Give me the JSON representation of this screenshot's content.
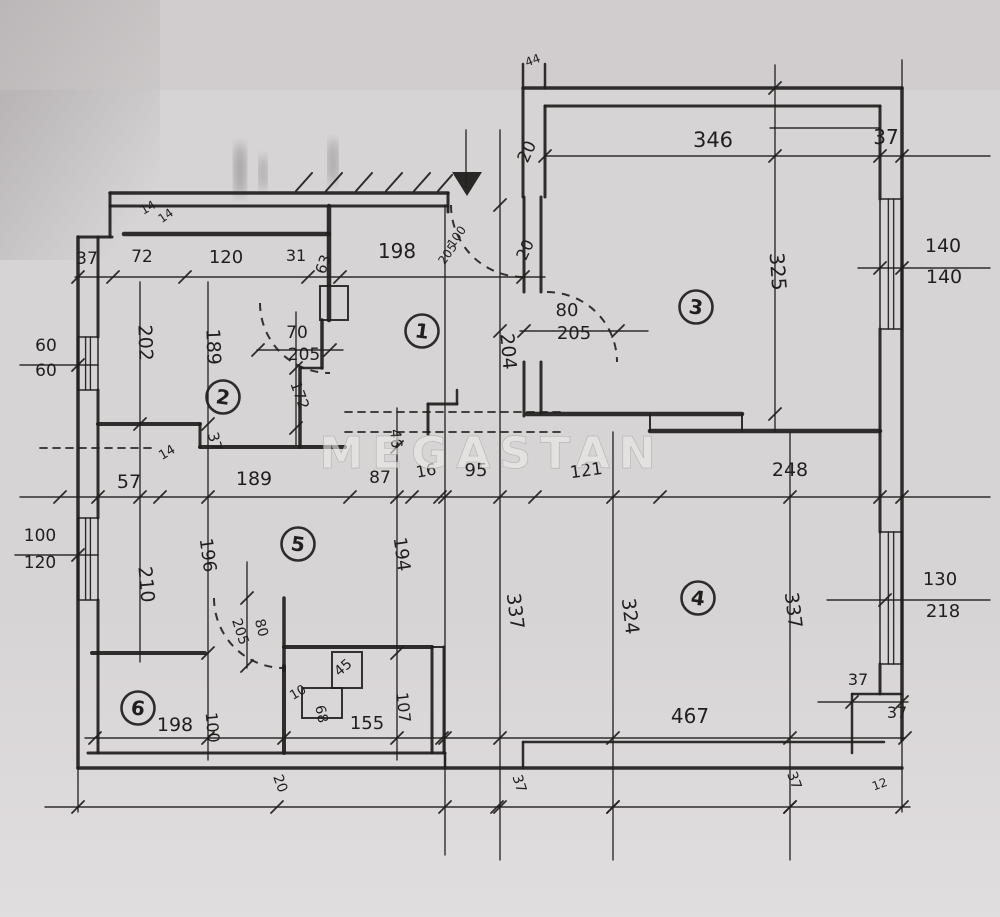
{
  "meta": {
    "type": "hand-drawn floor plan sketch",
    "units_hint": "cm"
  },
  "watermark": {
    "text": "MEGASTAN"
  },
  "paper": {
    "bg": "#d7d4d5",
    "bg_light": "#dedbdc",
    "shadow": "#8e898b",
    "ink": "#211f1e"
  },
  "rooms": [
    {
      "n": "1",
      "x": 422,
      "y": 331
    },
    {
      "n": "2",
      "x": 223,
      "y": 397
    },
    {
      "n": "3",
      "x": 696,
      "y": 307
    },
    {
      "n": "4",
      "x": 698,
      "y": 598
    },
    {
      "n": "5",
      "x": 298,
      "y": 544
    },
    {
      "n": "6",
      "x": 138,
      "y": 708
    }
  ],
  "labels": [
    {
      "t": "346",
      "x": 713,
      "y": 147,
      "r": 0,
      "s": 21
    },
    {
      "t": "37",
      "x": 886,
      "y": 144,
      "r": 0,
      "s": 20
    },
    {
      "t": "20",
      "x": 532,
      "y": 154,
      "r": -65,
      "s": 17
    },
    {
      "t": "44",
      "x": 534,
      "y": 64,
      "r": -20,
      "s": 12
    },
    {
      "t": "140",
      "x": 943,
      "y": 252,
      "r": 0,
      "s": 19
    },
    {
      "t": "140",
      "x": 944,
      "y": 283,
      "r": 0,
      "s": 19
    },
    {
      "t": "325",
      "x": 771,
      "y": 272,
      "r": 86,
      "s": 20
    },
    {
      "t": "80",
      "x": 567,
      "y": 316,
      "r": 0,
      "s": 18
    },
    {
      "t": "205",
      "x": 574,
      "y": 339,
      "r": 0,
      "s": 18
    },
    {
      "t": "20",
      "x": 530,
      "y": 252,
      "r": -65,
      "s": 16
    },
    {
      "t": "204",
      "x": 502,
      "y": 352,
      "r": 85,
      "s": 19
    },
    {
      "t": "198",
      "x": 397,
      "y": 258,
      "r": 0,
      "s": 20
    },
    {
      "t": "100",
      "x": 460,
      "y": 239,
      "r": -55,
      "s": 12
    },
    {
      "t": "205",
      "x": 451,
      "y": 256,
      "r": -55,
      "s": 12
    },
    {
      "t": "37",
      "x": 87,
      "y": 264,
      "r": 0,
      "s": 17
    },
    {
      "t": "72",
      "x": 142,
      "y": 262,
      "r": 0,
      "s": 17
    },
    {
      "t": "120",
      "x": 226,
      "y": 263,
      "r": 0,
      "s": 18
    },
    {
      "t": "31",
      "x": 296,
      "y": 261,
      "r": 0,
      "s": 16
    },
    {
      "t": "63",
      "x": 328,
      "y": 266,
      "r": -70,
      "s": 15
    },
    {
      "t": "14",
      "x": 150,
      "y": 211,
      "r": -30,
      "s": 12
    },
    {
      "t": "14",
      "x": 168,
      "y": 219,
      "r": -35,
      "s": 12
    },
    {
      "t": "202",
      "x": 139,
      "y": 343,
      "r": 88,
      "s": 19
    },
    {
      "t": "189",
      "x": 207,
      "y": 347,
      "r": 88,
      "s": 19
    },
    {
      "t": "70",
      "x": 297,
      "y": 338,
      "r": 0,
      "s": 17
    },
    {
      "t": "205",
      "x": 304,
      "y": 360,
      "r": 0,
      "s": 17
    },
    {
      "t": "172",
      "x": 295,
      "y": 397,
      "r": 70,
      "s": 15
    },
    {
      "t": "60",
      "x": 46,
      "y": 351,
      "r": 0,
      "s": 17
    },
    {
      "t": "60",
      "x": 46,
      "y": 376,
      "r": 0,
      "s": 17
    },
    {
      "t": "37",
      "x": 210,
      "y": 443,
      "r": 75,
      "s": 15
    },
    {
      "t": "14",
      "x": 169,
      "y": 456,
      "r": -30,
      "s": 13
    },
    {
      "t": "57",
      "x": 129,
      "y": 488,
      "r": 0,
      "s": 19
    },
    {
      "t": "189",
      "x": 254,
      "y": 485,
      "r": 0,
      "s": 19
    },
    {
      "t": "87",
      "x": 380,
      "y": 483,
      "r": 0,
      "s": 17
    },
    {
      "t": "16",
      "x": 427,
      "y": 476,
      "r": -10,
      "s": 16
    },
    {
      "t": "95",
      "x": 476,
      "y": 476,
      "r": 0,
      "s": 18
    },
    {
      "t": "46",
      "x": 391,
      "y": 439,
      "r": 85,
      "s": 15
    },
    {
      "t": "121",
      "x": 587,
      "y": 476,
      "r": -8,
      "s": 17
    },
    {
      "t": "248",
      "x": 790,
      "y": 476,
      "r": 0,
      "s": 19
    },
    {
      "t": "100",
      "x": 40,
      "y": 541,
      "r": 0,
      "s": 17
    },
    {
      "t": "120",
      "x": 40,
      "y": 568,
      "r": 0,
      "s": 17
    },
    {
      "t": "210",
      "x": 140,
      "y": 585,
      "r": 85,
      "s": 19
    },
    {
      "t": "196",
      "x": 202,
      "y": 556,
      "r": 82,
      "s": 18
    },
    {
      "t": "194",
      "x": 396,
      "y": 555,
      "r": 82,
      "s": 18
    },
    {
      "t": "337",
      "x": 509,
      "y": 612,
      "r": 83,
      "s": 19
    },
    {
      "t": "324",
      "x": 624,
      "y": 617,
      "r": 83,
      "s": 19
    },
    {
      "t": "337",
      "x": 787,
      "y": 611,
      "r": 83,
      "s": 19
    },
    {
      "t": "130",
      "x": 940,
      "y": 585,
      "r": 0,
      "s": 18
    },
    {
      "t": "218",
      "x": 943,
      "y": 617,
      "r": 0,
      "s": 18
    },
    {
      "t": "205",
      "x": 236,
      "y": 633,
      "r": 72,
      "s": 14
    },
    {
      "t": "80",
      "x": 257,
      "y": 629,
      "r": 75,
      "s": 14
    },
    {
      "t": "198",
      "x": 175,
      "y": 731,
      "r": 0,
      "s": 19
    },
    {
      "t": "100",
      "x": 207,
      "y": 728,
      "r": 85,
      "s": 16
    },
    {
      "t": "45",
      "x": 346,
      "y": 671,
      "r": -40,
      "s": 14
    },
    {
      "t": "10",
      "x": 300,
      "y": 696,
      "r": -30,
      "s": 13
    },
    {
      "t": "68",
      "x": 317,
      "y": 715,
      "r": 78,
      "s": 14
    },
    {
      "t": "107",
      "x": 398,
      "y": 708,
      "r": 84,
      "s": 16
    },
    {
      "t": "155",
      "x": 367,
      "y": 729,
      "r": 0,
      "s": 18
    },
    {
      "t": "20",
      "x": 276,
      "y": 785,
      "r": 70,
      "s": 14
    },
    {
      "t": "467",
      "x": 690,
      "y": 723,
      "r": 0,
      "s": 20
    },
    {
      "t": "37",
      "x": 515,
      "y": 785,
      "r": 72,
      "s": 14
    },
    {
      "t": "37",
      "x": 858,
      "y": 685,
      "r": 0,
      "s": 16
    },
    {
      "t": "37",
      "x": 897,
      "y": 718,
      "r": 0,
      "s": 16
    },
    {
      "t": "37",
      "x": 790,
      "y": 782,
      "r": 70,
      "s": 14
    },
    {
      "t": "12",
      "x": 881,
      "y": 788,
      "r": -20,
      "s": 12
    }
  ],
  "walls": [
    [
      110,
      193,
      448,
      193,
      3.5
    ],
    [
      110,
      206,
      448,
      206,
      3
    ],
    [
      110,
      193,
      110,
      237,
      3
    ],
    [
      78,
      237,
      112,
      237,
      3
    ],
    [
      78,
      237,
      78,
      768,
      3.5
    ],
    [
      98,
      237,
      98,
      337,
      3
    ],
    [
      98,
      390,
      98,
      518,
      3
    ],
    [
      98,
      600,
      98,
      753,
      3
    ],
    [
      88,
      753,
      445,
      753,
      3
    ],
    [
      523,
      742,
      884,
      742,
      2.5
    ],
    [
      445,
      753,
      445,
      768,
      2.5
    ],
    [
      523,
      742,
      523,
      768,
      2.5
    ],
    [
      78,
      768,
      902,
      768,
      3.5
    ],
    [
      902,
      88,
      902,
      740,
      3.5
    ],
    [
      852,
      694,
      902,
      694,
      2.5
    ],
    [
      852,
      694,
      852,
      753,
      2.5
    ],
    [
      880,
      106,
      880,
      199,
      3
    ],
    [
      880,
      329,
      880,
      532,
      3
    ],
    [
      880,
      664,
      880,
      694,
      3
    ],
    [
      523,
      88,
      902,
      88,
      3.5
    ],
    [
      545,
      106,
      880,
      106,
      3
    ],
    [
      523,
      88,
      523,
      197,
      3
    ],
    [
      545,
      106,
      545,
      197,
      3
    ],
    [
      448,
      193,
      448,
      212,
      3
    ],
    [
      523,
      64,
      523,
      88,
      2.5
    ],
    [
      545,
      64,
      545,
      88,
      2.5
    ],
    [
      124,
      234,
      329,
      234,
      4.5
    ],
    [
      329,
      206,
      329,
      320,
      4.5
    ],
    [
      524,
      197,
      524,
      292,
      3
    ],
    [
      541,
      197,
      541,
      292,
      3
    ],
    [
      524,
      362,
      524,
      416,
      3
    ],
    [
      541,
      362,
      541,
      414,
      3
    ],
    [
      527,
      414,
      742,
      414,
      4.5
    ],
    [
      650,
      431,
      880,
      431,
      4.5
    ],
    [
      650,
      414,
      650,
      431,
      2
    ],
    [
      742,
      414,
      742,
      431,
      2
    ],
    [
      98,
      424,
      200,
      424,
      4
    ],
    [
      200,
      424,
      200,
      447,
      3
    ],
    [
      200,
      447,
      345,
      447,
      4
    ],
    [
      300,
      368,
      300,
      447,
      3.5
    ],
    [
      322,
      320,
      322,
      368,
      3.5
    ],
    [
      300,
      368,
      322,
      368,
      2.5
    ],
    [
      428,
      404,
      428,
      434,
      3
    ],
    [
      428,
      404,
      457,
      404,
      3
    ],
    [
      457,
      390,
      457,
      404,
      2.5
    ],
    [
      92,
      653,
      205,
      653,
      4
    ],
    [
      284,
      598,
      284,
      670,
      3.5
    ],
    [
      284,
      666,
      284,
      753,
      4
    ],
    [
      284,
      647,
      432,
      647,
      4
    ],
    [
      432,
      647,
      432,
      753,
      3
    ],
    [
      444,
      647,
      444,
      753,
      3
    ],
    [
      432,
      647,
      444,
      647,
      2
    ]
  ],
  "windows": [
    [
      78,
      337,
      20,
      53
    ],
    [
      78,
      518,
      20,
      82
    ],
    [
      880,
      199,
      22,
      130
    ],
    [
      880,
      532,
      22,
      132
    ]
  ],
  "rects": [
    [
      320,
      286,
      28,
      34
    ],
    [
      302,
      688,
      40,
      30
    ],
    [
      332,
      652,
      30,
      36
    ]
  ],
  "dimlines": [
    {
      "x1": 545,
      "y1": 156,
      "x2": 990,
      "y2": 156,
      "ticks": [
        545,
        880,
        902
      ]
    },
    {
      "x1": 858,
      "y1": 268,
      "x2": 990,
      "y2": 268,
      "ticks": [
        880,
        902
      ]
    },
    {
      "x1": 520,
      "y1": 331,
      "x2": 648,
      "y2": 331,
      "ticks": [
        524,
        618
      ]
    },
    {
      "x1": 75,
      "y1": 277,
      "x2": 545,
      "y2": 277,
      "ticks": [
        78,
        113,
        185,
        308,
        340,
        523
      ]
    },
    {
      "x1": 20,
      "y1": 365,
      "x2": 98,
      "y2": 365,
      "ticks": [
        78
      ]
    },
    {
      "x1": 20,
      "y1": 497,
      "x2": 990,
      "y2": 497,
      "ticks": [
        60,
        98,
        160,
        350,
        412,
        440,
        535,
        660,
        880,
        902
      ]
    },
    {
      "x1": 15,
      "y1": 555,
      "x2": 98,
      "y2": 555,
      "ticks": [
        78
      ]
    },
    {
      "x1": 827,
      "y1": 600,
      "x2": 990,
      "y2": 600,
      "ticks": [
        885
      ]
    },
    {
      "x1": 85,
      "y1": 738,
      "x2": 905,
      "y2": 738,
      "ticks": [
        95,
        284,
        442,
        905
      ]
    },
    {
      "x1": 45,
      "y1": 807,
      "x2": 910,
      "y2": 807,
      "ticks": [
        78,
        277,
        497,
        613,
        790,
        902
      ]
    },
    {
      "x1": 257,
      "y1": 350,
      "x2": 343,
      "y2": 350,
      "ticks": [
        258,
        330
      ]
    },
    {
      "x1": 770,
      "y1": 128,
      "x2": 880,
      "y2": 128,
      "ticks": []
    },
    {
      "x1": 818,
      "y1": 702,
      "x2": 908,
      "y2": 702,
      "ticks": [
        852,
        902
      ]
    },
    {
      "x1": 140,
      "y1": 282,
      "x2": 140,
      "y2": 662,
      "ticks": [
        424,
        497
      ]
    },
    {
      "x1": 208,
      "y1": 282,
      "x2": 208,
      "y2": 760,
      "ticks": [
        424,
        497,
        653,
        738
      ]
    },
    {
      "x1": 296,
      "y1": 312,
      "x2": 296,
      "y2": 445,
      "ticks": [
        368,
        428
      ]
    },
    {
      "x1": 397,
      "y1": 408,
      "x2": 397,
      "y2": 760,
      "ticks": [
        447,
        497,
        653,
        738
      ]
    },
    {
      "x1": 445,
      "y1": 205,
      "x2": 445,
      "y2": 855,
      "ticks": [
        497,
        738,
        807
      ]
    },
    {
      "x1": 500,
      "y1": 130,
      "x2": 500,
      "y2": 860,
      "ticks": [
        205,
        331,
        497,
        738,
        807
      ]
    },
    {
      "x1": 613,
      "y1": 432,
      "x2": 613,
      "y2": 860,
      "ticks": [
        497,
        738,
        807
      ]
    },
    {
      "x1": 775,
      "y1": 65,
      "x2": 775,
      "y2": 432,
      "ticks": [
        88,
        156,
        414
      ]
    },
    {
      "x1": 790,
      "y1": 432,
      "x2": 790,
      "y2": 860,
      "ticks": [
        497,
        738,
        807
      ]
    },
    {
      "x1": 78,
      "y1": 768,
      "x2": 78,
      "y2": 812,
      "ticks": []
    },
    {
      "x1": 902,
      "y1": 740,
      "x2": 902,
      "y2": 812,
      "ticks": []
    },
    {
      "x1": 902,
      "y1": 60,
      "x2": 902,
      "y2": 88,
      "ticks": []
    },
    {
      "x1": 247,
      "y1": 562,
      "x2": 247,
      "y2": 668,
      "ticks": [
        598,
        666
      ]
    },
    {
      "x1": 466,
      "y1": 130,
      "x2": 466,
      "y2": 188,
      "ticks": []
    }
  ],
  "dashes": [
    [
      345,
      412,
      560,
      412
    ],
    [
      345,
      432,
      560,
      432
    ],
    [
      40,
      448,
      155,
      448
    ]
  ],
  "arcs": [
    "M451,205 A72,72 0 0 0 523,277",
    "M547,292 A70,70 0 0 1 617,362",
    "M260,303 A70,70 0 0 0 330,373",
    "M214,598 A70,70 0 0 0 284,668"
  ],
  "hatch": [
    [
      296,
      191,
      312,
      173
    ],
    [
      326,
      191,
      342,
      173
    ],
    [
      356,
      191,
      372,
      173
    ],
    [
      386,
      191,
      402,
      173
    ],
    [
      414,
      191,
      430,
      173
    ],
    [
      438,
      191,
      452,
      175
    ]
  ],
  "triangle": "452,172 482,172 467,196",
  "smudges": [
    {
      "cx": 240,
      "cy": 170,
      "rx": 6,
      "ry": 27
    },
    {
      "cx": 333,
      "cy": 162,
      "rx": 5,
      "ry": 23
    },
    {
      "cx": 263,
      "cy": 173,
      "rx": 4,
      "ry": 18
    }
  ]
}
